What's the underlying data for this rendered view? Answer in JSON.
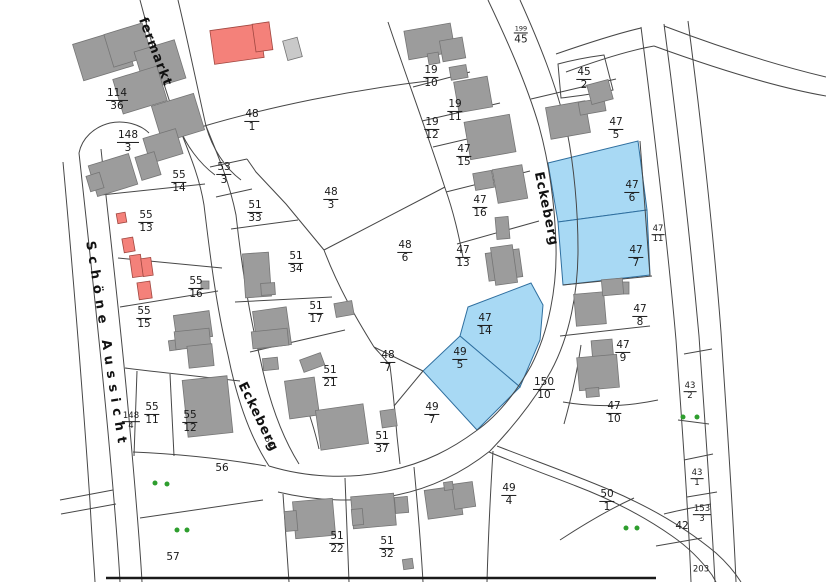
{
  "map": {
    "colors": {
      "parcel_line": "#474747",
      "building_fill": "#9c9c9c",
      "building_stroke": "#757575",
      "building_light_fill": "#c9c9c9",
      "highlight_fill": "#a8d9f4",
      "highlight_stroke": "#2f6f9f",
      "red_building_fill": "#f4817a",
      "red_building_stroke": "#a04740",
      "tree_green": "#2e9e2e",
      "label_color": "#1a1a1a"
    },
    "street_labels": [
      {
        "text": "fermarkt",
        "x": 155,
        "y": 52,
        "rot": 69,
        "spacing": 1
      },
      {
        "text": "Schöne Aussicht",
        "x": 106,
        "y": 345,
        "rot": 81,
        "spacing": 6
      },
      {
        "text": "Eckeberg",
        "x": 258,
        "y": 417,
        "rot": 64,
        "spacing": 1
      },
      {
        "text": "Eckeberg",
        "x": 546,
        "y": 209,
        "rot": 78,
        "spacing": 1
      }
    ],
    "small_street_numbers": [
      {
        "text": "50",
        "x": 269,
        "y": 442,
        "rot": 65
      }
    ],
    "parcels": [
      {
        "num": "114",
        "den": "36",
        "x": 117,
        "y": 100
      },
      {
        "num": "148",
        "den": "3",
        "x": 128,
        "y": 142
      },
      {
        "num": "48",
        "den": "1",
        "x": 252,
        "y": 121
      },
      {
        "num": "199",
        "den": "45",
        "x": 521,
        "y": 34,
        "style": "tinynum"
      },
      {
        "num": "45",
        "den": "2",
        "x": 584,
        "y": 79
      },
      {
        "num": "47",
        "den": "5",
        "x": 616,
        "y": 129
      },
      {
        "num": "47",
        "den": "6",
        "x": 632,
        "y": 192
      },
      {
        "num": "47",
        "den": "11",
        "x": 658,
        "y": 235,
        "style": "small"
      },
      {
        "num": "47",
        "den": "7",
        "x": 636,
        "y": 257
      },
      {
        "num": "19",
        "den": "10",
        "x": 431,
        "y": 77
      },
      {
        "num": "19",
        "den": "11",
        "x": 455,
        "y": 111
      },
      {
        "num": "19",
        "den": "12",
        "x": 432,
        "y": 129
      },
      {
        "num": "47",
        "den": "15",
        "x": 464,
        "y": 156
      },
      {
        "num": "47",
        "den": "16",
        "x": 480,
        "y": 207
      },
      {
        "num": "47",
        "den": "13",
        "x": 463,
        "y": 257
      },
      {
        "num": "53",
        "den": "3",
        "x": 224,
        "y": 174
      },
      {
        "num": "55",
        "den": "14",
        "x": 179,
        "y": 182
      },
      {
        "num": "51",
        "den": "33",
        "x": 255,
        "y": 212
      },
      {
        "num": "55",
        "den": "13",
        "x": 146,
        "y": 222
      },
      {
        "num": "48",
        "den": "3",
        "x": 331,
        "y": 199
      },
      {
        "num": "51",
        "den": "34",
        "x": 296,
        "y": 263
      },
      {
        "num": "48",
        "den": "6",
        "x": 405,
        "y": 252
      },
      {
        "num": "55",
        "den": "16",
        "x": 196,
        "y": 288
      },
      {
        "num": "55",
        "den": "15",
        "x": 144,
        "y": 318
      },
      {
        "num": "51",
        "den": "17",
        "x": 316,
        "y": 313
      },
      {
        "num": "48",
        "den": "7",
        "x": 388,
        "y": 362
      },
      {
        "num": "47",
        "den": "14",
        "x": 485,
        "y": 325
      },
      {
        "num": "49",
        "den": "5",
        "x": 460,
        "y": 359
      },
      {
        "num": "51",
        "den": "21",
        "x": 330,
        "y": 377
      },
      {
        "num": "49",
        "den": "7",
        "x": 432,
        "y": 414
      },
      {
        "num": "150",
        "den": "10",
        "x": 544,
        "y": 389
      },
      {
        "num": "47",
        "den": "8",
        "x": 640,
        "y": 316
      },
      {
        "num": "47",
        "den": "9",
        "x": 623,
        "y": 352
      },
      {
        "num": "47",
        "den": "10",
        "x": 614,
        "y": 413
      },
      {
        "num": "43",
        "den": "2",
        "x": 690,
        "y": 392,
        "style": "small"
      },
      {
        "num": "148",
        "den": "4",
        "x": 131,
        "y": 422,
        "style": "small"
      },
      {
        "num": "55",
        "den": "11",
        "x": 152,
        "y": 414
      },
      {
        "num": "55",
        "den": "12",
        "x": 190,
        "y": 422
      },
      {
        "num": "56",
        "x": 222,
        "y": 469
      },
      {
        "num": "51",
        "den": "37",
        "x": 382,
        "y": 443
      },
      {
        "num": "49",
        "den": "4",
        "x": 509,
        "y": 495
      },
      {
        "num": "51",
        "den": "22",
        "x": 337,
        "y": 543
      },
      {
        "num": "51",
        "den": "32",
        "x": 387,
        "y": 548
      },
      {
        "num": "50",
        "den": "1",
        "x": 607,
        "y": 501
      },
      {
        "num": "43",
        "den": "1",
        "x": 697,
        "y": 479,
        "style": "small"
      },
      {
        "num": "153",
        "den": "3",
        "x": 702,
        "y": 515,
        "style": "small"
      },
      {
        "num": "42",
        "x": 682,
        "y": 527
      },
      {
        "num": "203",
        "x": 701,
        "y": 570,
        "style": "small"
      },
      {
        "num": "57",
        "x": 173,
        "y": 558
      }
    ],
    "highlighted_parcels": [
      {
        "id": "47-6",
        "points": "548,163 638,141 647,210 558,222"
      },
      {
        "id": "47-7",
        "points": "558,222 647,210 650,275 563,285"
      },
      {
        "id": "47-14",
        "points": "468,307 531,283 543,305 540,340 520,387 460,336"
      },
      {
        "id": "49-5",
        "points": "460,336 520,387 477,430 423,371"
      }
    ],
    "trees": [
      {
        "x": 155,
        "y": 483
      },
      {
        "x": 167,
        "y": 484
      },
      {
        "x": 177,
        "y": 530
      },
      {
        "x": 187,
        "y": 530
      },
      {
        "x": 683,
        "y": 417
      },
      {
        "x": 697,
        "y": 417
      },
      {
        "x": 626,
        "y": 528
      },
      {
        "x": 637,
        "y": 528
      }
    ]
  }
}
